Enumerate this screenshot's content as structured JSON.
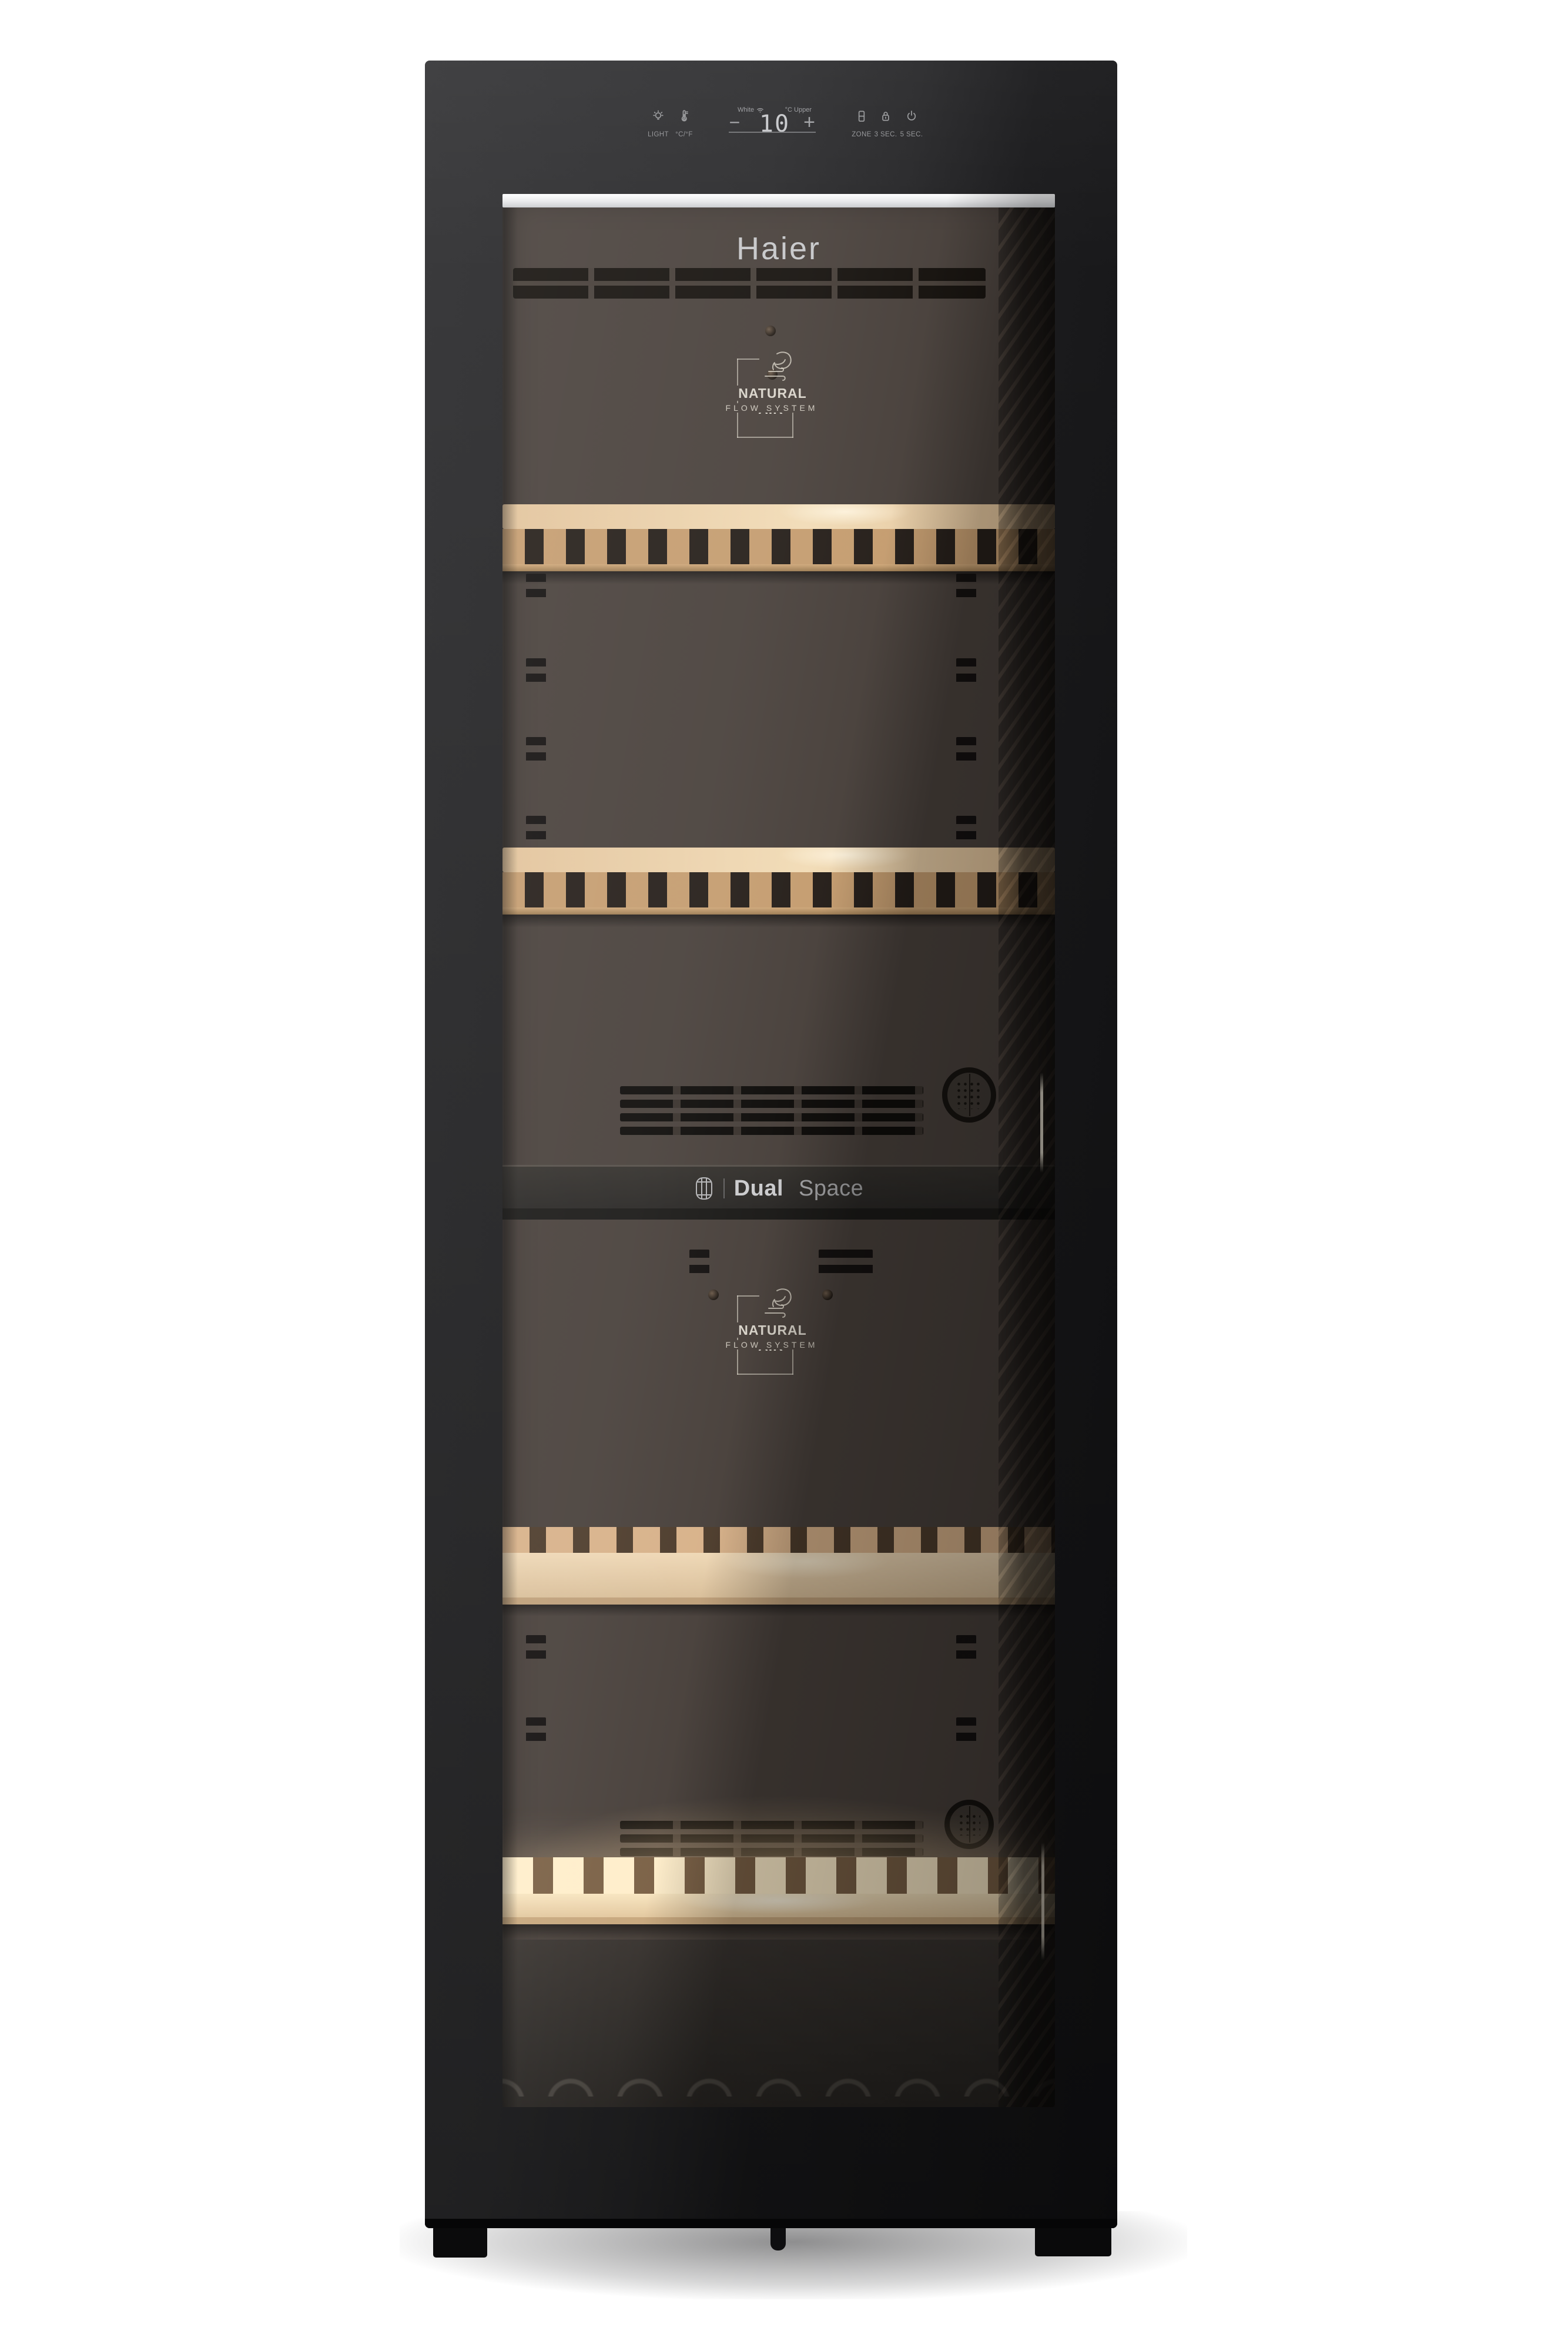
{
  "brand": {
    "logo_text": "Haier"
  },
  "control_panel": {
    "buttons": {
      "light": {
        "label": "LIGHT",
        "icon": "light-bulb-icon"
      },
      "temp_unit": {
        "label": "°C/°F",
        "icon": "thermometer-icon"
      },
      "minus": {
        "label": "−"
      },
      "plus": {
        "label": "+"
      },
      "zone": {
        "label": "ZONE",
        "icon": "zone-compartments-icon"
      },
      "lock": {
        "label": "3 SEC.",
        "icon": "lock-icon"
      },
      "power": {
        "label": "5 SEC.",
        "icon": "power-icon"
      }
    },
    "display": {
      "mode_label": "White",
      "wifi_icon": "wifi-icon",
      "temperature": "10",
      "unit_label": "°C",
      "zone_label": "Upper"
    }
  },
  "interior": {
    "upper_zone_badge": {
      "line1": "NATURAL AIR",
      "line2": "FLOW SYSTEM",
      "icon": "leaf-airflow-icon"
    },
    "lower_zone_badge": {
      "line1": "NATURAL AIR",
      "line2": "FLOW SYSTEM",
      "icon": "leaf-airflow-icon"
    },
    "divider_label": {
      "bold": "Dual",
      "light": "Space",
      "icon": "wine-barrel-icon"
    }
  },
  "colors": {
    "background": "#ffffff",
    "cabinet_black": "#1a1a1c",
    "interior_brown": "#49413c",
    "shelf_wood": "#e9d0ab",
    "backlit_wood": "#ffeecb",
    "panel_text": "#97989b",
    "display_digits": "#c9cacd",
    "logo_text": "#c6c7c9",
    "badge_line": "#d9d4ca",
    "led_bar": "#ffffff"
  }
}
